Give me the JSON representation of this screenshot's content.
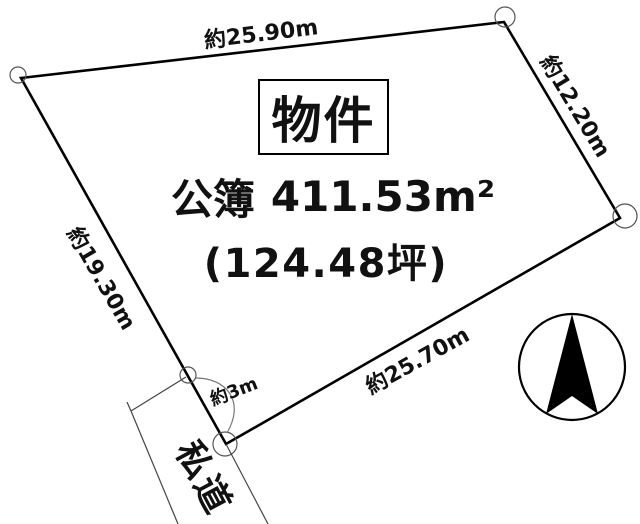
{
  "property": {
    "label": "物件",
    "area": {
      "register_label": "公簿",
      "value": "411.53",
      "unit": "m²"
    },
    "area_tsubo": "(124.48坪)"
  },
  "edges": {
    "top": "約25.90m",
    "right": "約12.20m",
    "left": "約19.30m",
    "bottom": "約25.70m",
    "frontage": "約3m"
  },
  "road": {
    "label": "私道"
  },
  "compass": {
    "icon": "north-arrow-icon"
  },
  "colors": {
    "boundary": "#000000",
    "marker": "#555555",
    "road_line": "#444444",
    "text": "#111111",
    "background": "#ffffff"
  }
}
